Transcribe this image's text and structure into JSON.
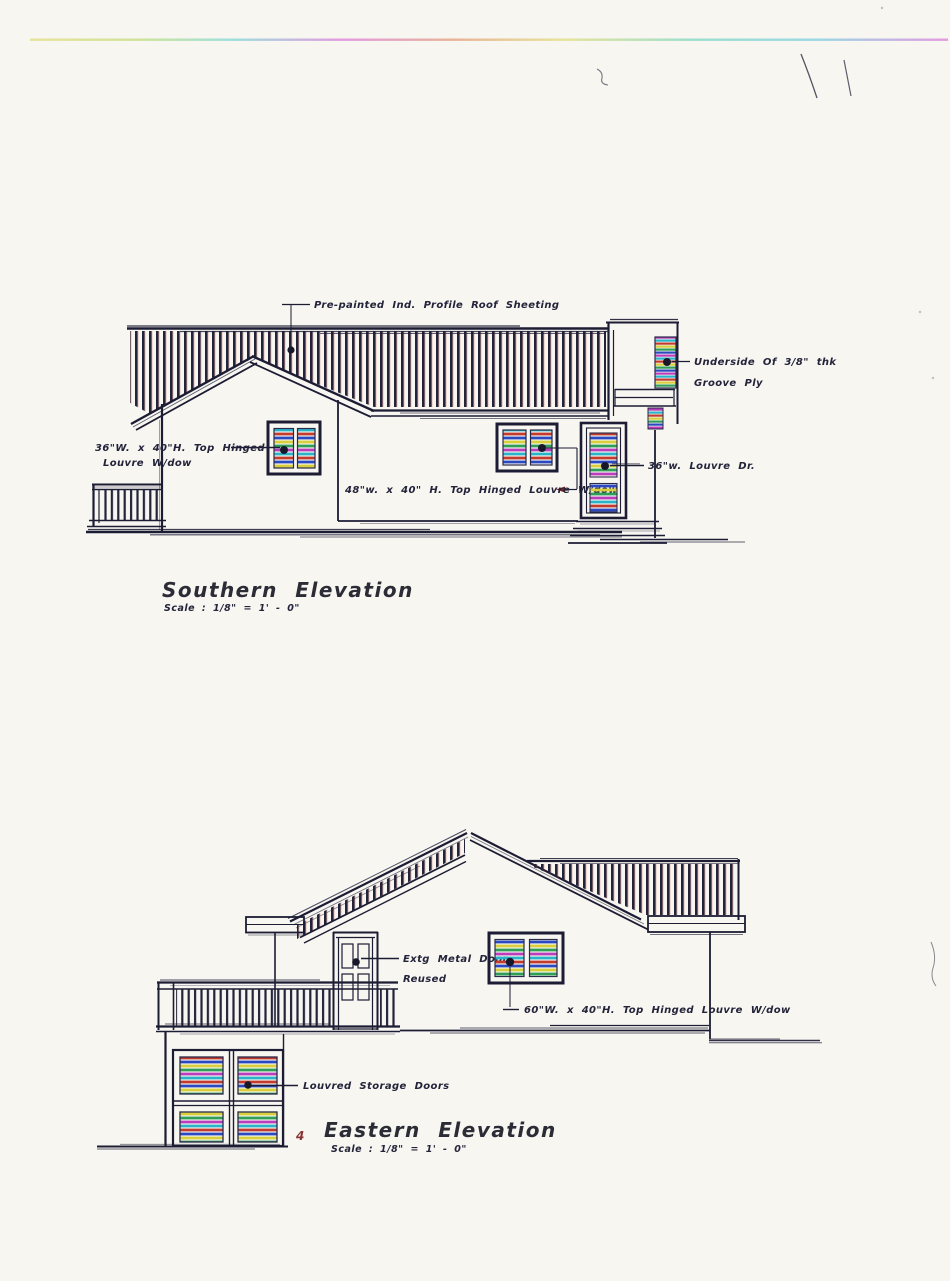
{
  "document": {
    "paper_color": "#f7f6f1",
    "ink_color": "#23233a"
  },
  "southern": {
    "title": "Southern Elevation",
    "scale": "Scale : 1/8\" = 1' - 0\"",
    "labels": {
      "roof_sheeting": "Pre-painted Ind. Profile Roof Sheeting",
      "left_window_line1": "36\"W. x 40\"H. Top Hinged",
      "left_window_line2": "Louvre W/dow",
      "mid_window": "48\"w. x 40\" H. Top Hinged Louvre W/dow",
      "louvre_door": "36\"w. Louvre Dr.",
      "groove_ply_line1": "Underside Of 3/8\" thk",
      "groove_ply_line2": "Groove Ply"
    }
  },
  "eastern": {
    "title": "Eastern Elevation",
    "scale": "Scale : 1/8\" = 1' - 0\"",
    "sheet_marker": "4",
    "labels": {
      "metal_door_line1": "Extg Metal Door",
      "metal_door_line2": "Reused",
      "window": "60\"W. x 40\"H. Top Hinged Louvre W/dow",
      "storage_doors": "Louvred Storage Doors"
    }
  },
  "palette": {
    "stripe_red": "#c23b2e",
    "stripe_blue": "#2b49c0",
    "stripe_yellow": "#d8cf3a",
    "stripe_green": "#2f9e57",
    "stripe_magenta": "#bb3dbb",
    "stripe_cyan": "#2ab4c9"
  }
}
